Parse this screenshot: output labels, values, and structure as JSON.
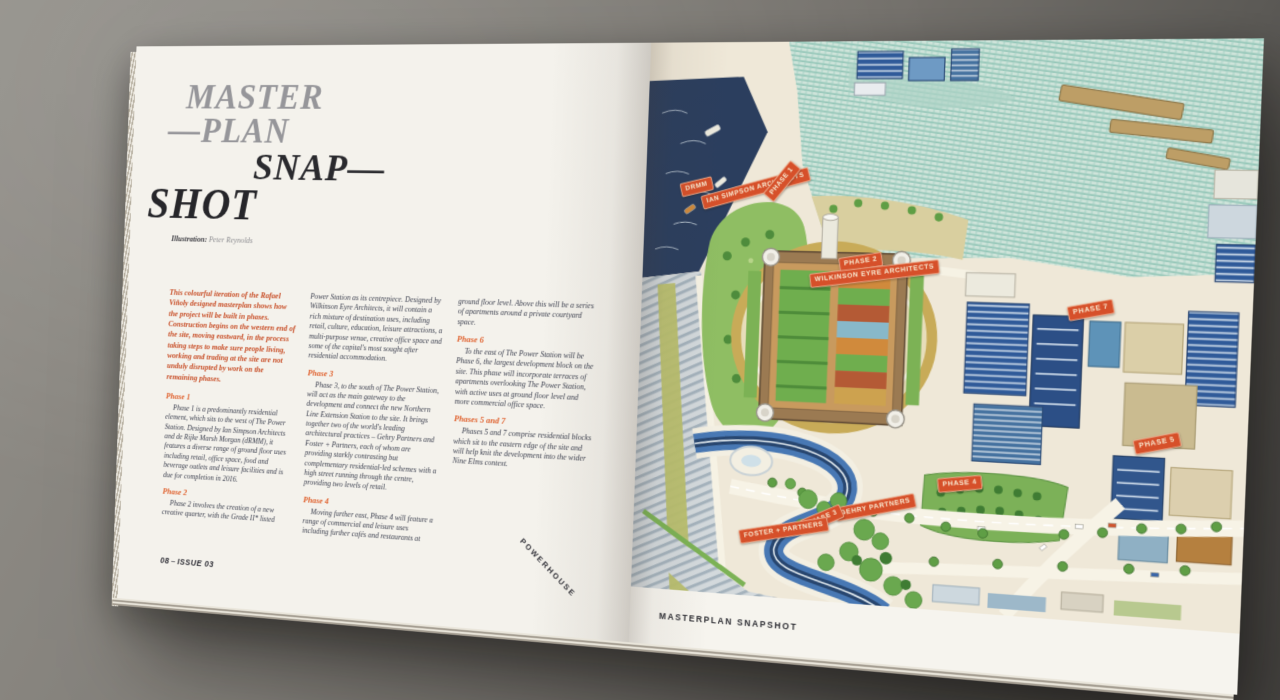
{
  "left_page": {
    "title": {
      "line1": "MASTER",
      "line2": "—PLAN",
      "line3": "SNAP—",
      "line4": "SHOT"
    },
    "credit": {
      "label": "Illustration:",
      "name": "Peter Reynolds"
    },
    "article": {
      "intro": "This colourful iteration of the Rafael Viñoly designed masterplan shows how the project will be built in phases. Construction begins on the western end of the site, moving eastward, in the process taking steps to make sure people living, working and trading at the site are not unduly disrupted by work on the remaining phases.",
      "phases": [
        {
          "heading": "Phase 1",
          "body": "Phase 1 is a predominantly residential element, which sits to the west of The Power Station. Designed by Ian Simpson Architects and de Rijke Marsh Morgan (dRMM), it features a diverse range of ground floor uses including retail, office space, food and beverage outlets and leisure facilities and is due for completion in 2016."
        },
        {
          "heading": "Phase 2",
          "body": "Phase 2 involves the creation of a new creative quarter, with the Grade II* listed Power Station as its centrepiece. Designed by Wilkinson Eyre Architects, it will contain a rich mixture of destination uses, including retail, culture, education, leisure attractions, a multi-purpose venue, creative office space and some of the capital's most sought after residential accommodation."
        },
        {
          "heading": "Phase 3",
          "body": "Phase 3, to the south of The Power Station, will act as the main gateway to the development and connect the new Northern Line Extension Station to the site. It brings together two of the world's leading architectural practices – Gehry Partners and Foster + Partners, each of whom are providing starkly contrasting but complementary residential-led schemes with a high street running through the centre, providing two levels of retail."
        },
        {
          "heading": "Phase 4",
          "body": "Moving further east, Phase 4 will feature a range of commercial and leisure uses including further cafés and restaurants at ground floor level. Above this will be a series of apartments around a private courtyard space."
        },
        {
          "heading": "Phase 6",
          "body": "To the east of The Power Station will be Phase 6, the largest development block on the site. This phase will incorporate terraces of apartments overlooking The Power Station, with active uses at ground floor level and more commercial office space."
        },
        {
          "heading": "Phases 5 and 7",
          "body": "Phases 5 and 7 comprise residential blocks which sit to the eastern edge of the site and will help knit the development into the wider Nine Elms context."
        }
      ]
    },
    "footer": {
      "page": "08",
      "separator": "–",
      "issue": "ISSUE 03",
      "brand": "POWERHOUSE"
    }
  },
  "right_page": {
    "caption": "MASTERPLAN SNAPSHOT"
  },
  "map": {
    "tags": [
      {
        "label": "dRMM"
      },
      {
        "label": "Ian Simpson Architects"
      },
      {
        "label": "PHASE 1"
      },
      {
        "label": "PHASE 2"
      },
      {
        "label": "Wilkinson Eyre Architects"
      },
      {
        "label": "PHASE 7"
      },
      {
        "label": "PHASE 5"
      },
      {
        "label": "PHASE 4"
      },
      {
        "label": "Gehry Partners"
      },
      {
        "label": "PHASE 3"
      },
      {
        "label": "Foster + Partners"
      }
    ]
  },
  "colors": {
    "tag_red": "#d6502a",
    "heading_orange": "#e0622f",
    "intro_orange": "#c84e27",
    "title_gray": "#96969a",
    "ink": "#3d4150",
    "river_navy": "#2b3e5e",
    "water_teal": "#79b9a8",
    "surface_gray": "#74716c"
  }
}
